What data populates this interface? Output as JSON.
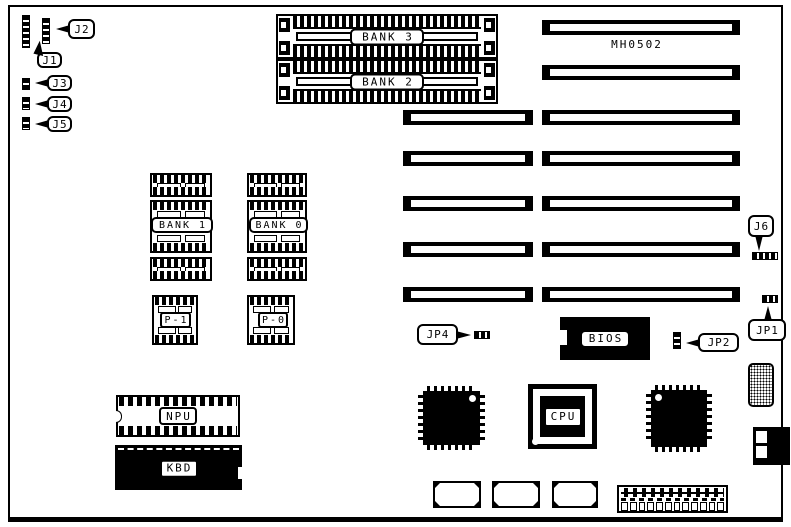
{
  "board": {
    "model": "MH0502"
  },
  "callouts": {
    "j1": "J1",
    "j2": "J2",
    "j3": "J3",
    "j4": "J4",
    "j5": "J5",
    "j6": "J6",
    "jp1": "JP1",
    "jp2": "JP2",
    "jp4": "JP4"
  },
  "memory": {
    "bank3": "BANK 3",
    "bank2": "BANK 2",
    "bank1": "BANK 1",
    "bank0": "BANK 0",
    "p1": "P-1",
    "p0": "P-0"
  },
  "chips": {
    "bios": "BIOS",
    "cpu": "CPU",
    "npu": "NPU",
    "kbd": "KBD"
  },
  "colors": {
    "ink": "#000000",
    "paper": "#ffffff"
  }
}
